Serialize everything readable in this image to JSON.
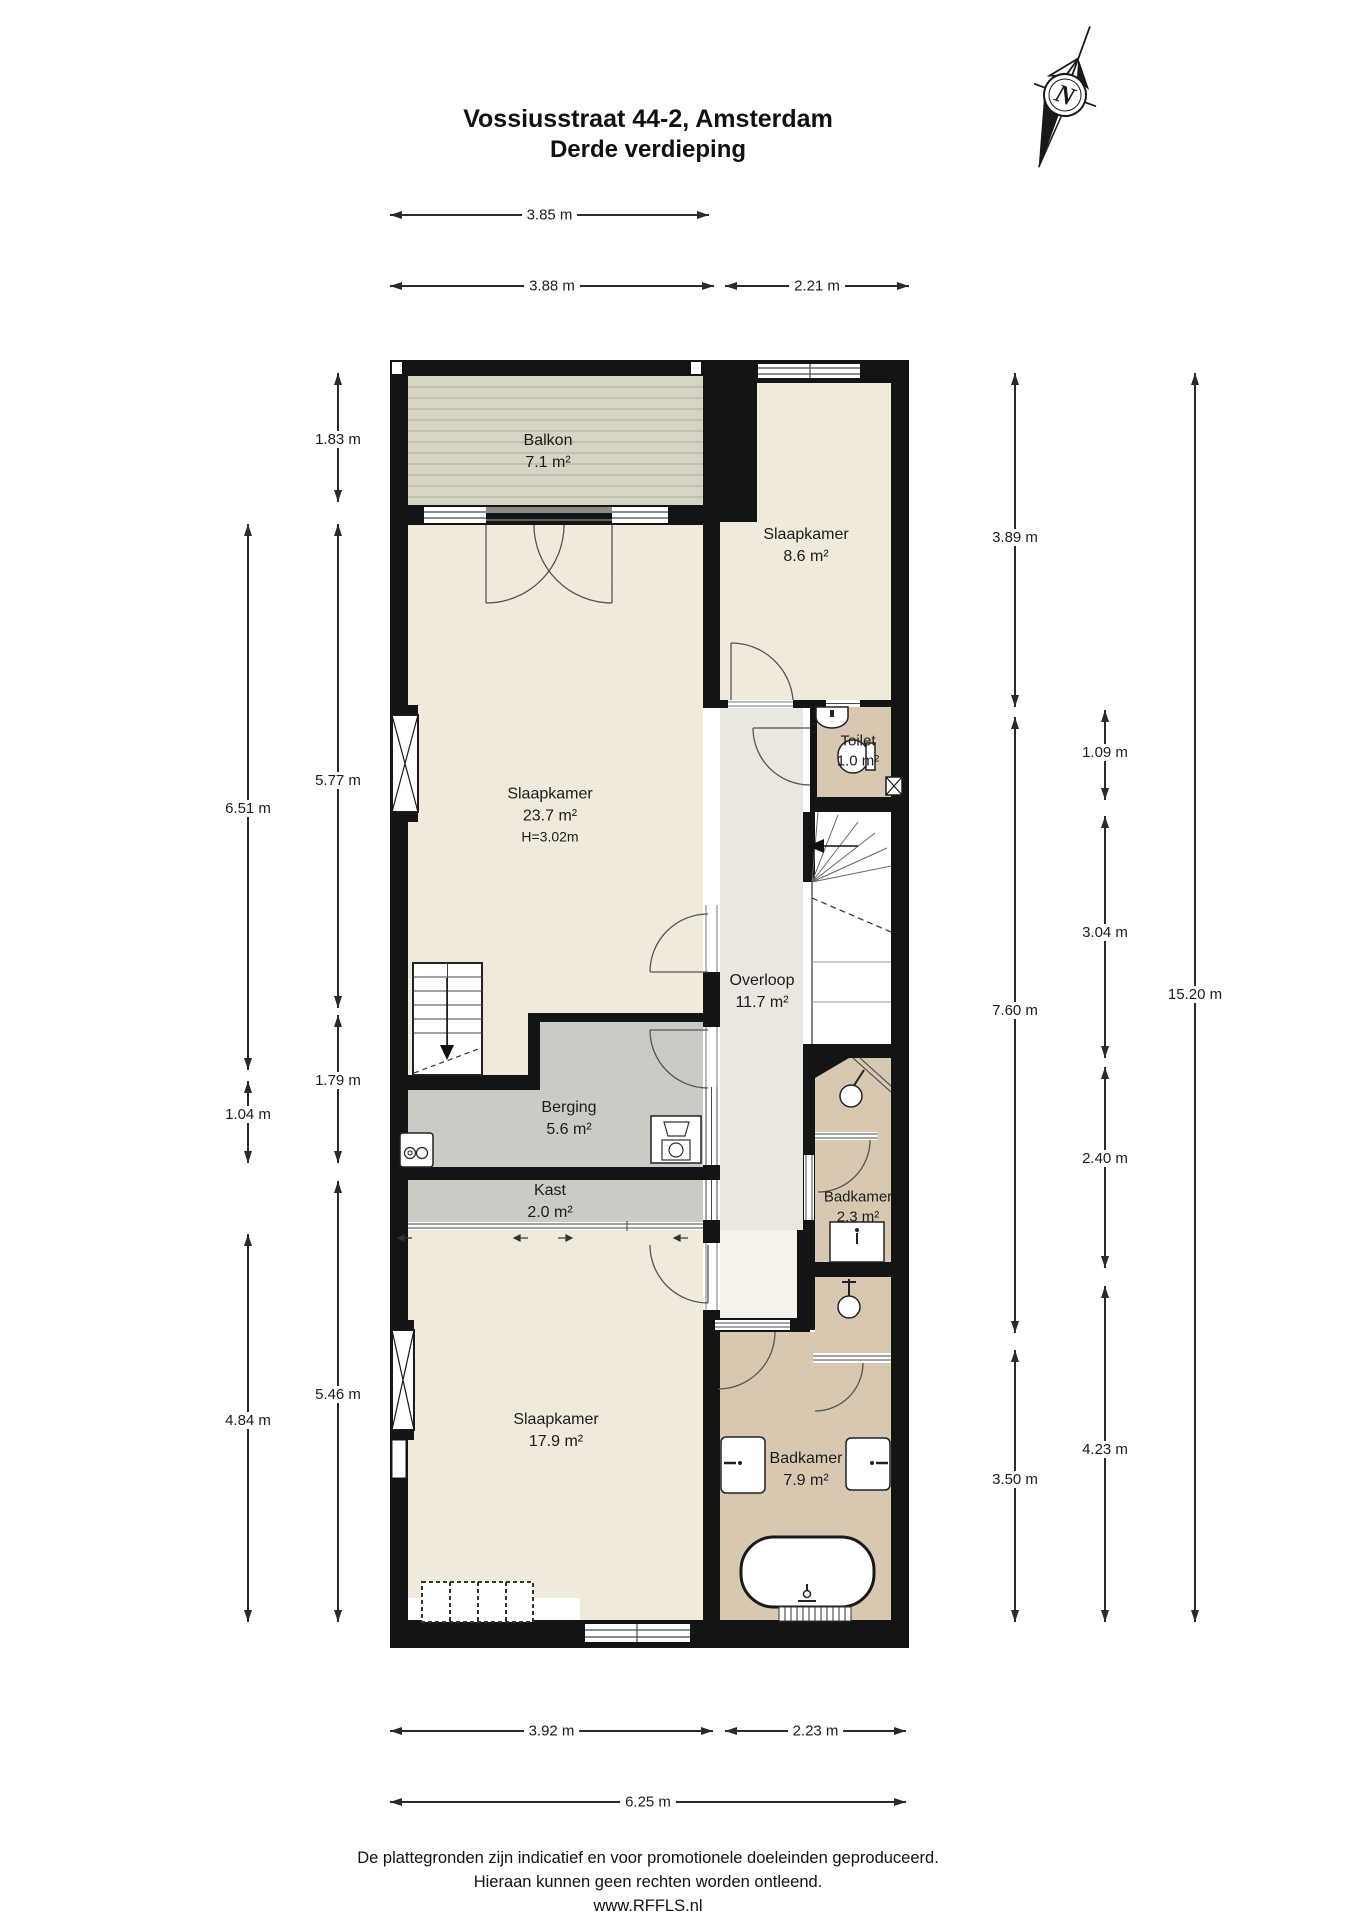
{
  "title": {
    "line1": "Vossiusstraat 44-2, Amsterdam",
    "line2": "Derde verdieping"
  },
  "compass": {
    "label": "N"
  },
  "rooms": [
    {
      "id": "balkon",
      "name": "Balkon",
      "area": "7.1 m²",
      "cx": 548,
      "cy": 452,
      "small": false
    },
    {
      "id": "slaapkamer-1",
      "name": "Slaapkamer",
      "area": "8.6 m²",
      "cx": 806,
      "cy": 546,
      "small": false
    },
    {
      "id": "slaapkamer-2",
      "name": "Slaapkamer",
      "area": "23.7 m²",
      "extra": "H=3.02m",
      "cx": 550,
      "cy": 815,
      "small": false
    },
    {
      "id": "toilet",
      "name": "Toilet",
      "area": "1.0 m²",
      "cx": 858,
      "cy": 751,
      "small": true
    },
    {
      "id": "overloop",
      "name": "Overloop",
      "area": "11.7 m²",
      "cx": 762,
      "cy": 992,
      "small": false
    },
    {
      "id": "berging",
      "name": "Berging",
      "area": "5.6 m²",
      "cx": 569,
      "cy": 1119,
      "small": false
    },
    {
      "id": "kast",
      "name": "Kast",
      "area": "2.0 m²",
      "cx": 550,
      "cy": 1202,
      "small": false
    },
    {
      "id": "badkamer-1",
      "name": "Badkamer",
      "area": "2.3 m²",
      "cx": 858,
      "cy": 1207,
      "small": true
    },
    {
      "id": "slaapkamer-3",
      "name": "Slaapkamer",
      "area": "17.9 m²",
      "cx": 556,
      "cy": 1431,
      "small": false
    },
    {
      "id": "badkamer-2",
      "name": "Badkamer",
      "area": "7.9 m²",
      "cx": 806,
      "cy": 1470,
      "small": false
    }
  ],
  "dims_h": [
    {
      "label": "3.85 m",
      "y": 215,
      "x1": 390,
      "x2": 709
    },
    {
      "label": "3.88 m",
      "y": 286,
      "x1": 390,
      "x2": 714
    },
    {
      "label": "2.21 m",
      "y": 286,
      "x1": 725,
      "x2": 909
    },
    {
      "label": "3.92 m",
      "y": 1731,
      "x1": 390,
      "x2": 713
    },
    {
      "label": "2.23 m",
      "y": 1731,
      "x1": 725,
      "x2": 906
    },
    {
      "label": "6.25 m",
      "y": 1802,
      "x1": 390,
      "x2": 906
    }
  ],
  "dims_v": [
    {
      "label": "1.83 m",
      "x": 338,
      "y1": 373,
      "y2": 502,
      "ly": 442
    },
    {
      "label": "5.77 m",
      "x": 338,
      "y1": 524,
      "y2": 1008,
      "ly": 783
    },
    {
      "label": "6.51 m",
      "x": 248,
      "y1": 524,
      "y2": 1070,
      "ly": 811
    },
    {
      "label": "1.79 m",
      "x": 338,
      "y1": 1015,
      "y2": 1163,
      "ly": 1083
    },
    {
      "label": "1.04 m",
      "x": 248,
      "y1": 1081,
      "y2": 1163,
      "ly": 1117
    },
    {
      "label": "5.46 m",
      "x": 338,
      "y1": 1181,
      "y2": 1622,
      "ly": 1397
    },
    {
      "label": "4.84 m",
      "x": 248,
      "y1": 1234,
      "y2": 1622,
      "ly": 1423
    },
    {
      "label": "3.89 m",
      "x": 1015,
      "y1": 373,
      "y2": 707,
      "ly": 540
    },
    {
      "label": "7.60 m",
      "x": 1015,
      "y1": 717,
      "y2": 1333,
      "ly": 1013
    },
    {
      "label": "3.50 m",
      "x": 1015,
      "y1": 1350,
      "y2": 1622,
      "ly": 1482
    },
    {
      "label": "1.09 m",
      "x": 1105,
      "y1": 710,
      "y2": 800,
      "ly": 755
    },
    {
      "label": "3.04 m",
      "x": 1105,
      "y1": 816,
      "y2": 1058,
      "ly": 935
    },
    {
      "label": "2.40 m",
      "x": 1105,
      "y1": 1067,
      "y2": 1268,
      "ly": 1161
    },
    {
      "label": "4.23 m",
      "x": 1105,
      "y1": 1286,
      "y2": 1622,
      "ly": 1452
    },
    {
      "label": "15.20 m",
      "x": 1195,
      "y1": 373,
      "y2": 1622,
      "ly": 997
    }
  ],
  "footer": {
    "line1": "De plattegronden zijn indicatief en voor promotionele doeleinden geproduceerd.",
    "line2": "Hieraan kunnen geen rechten worden ontleend.",
    "line3": "www.RFFLS.nl"
  },
  "colors": {
    "wall": "#141414",
    "room_beige": "#f0eadd",
    "hall": "#e9e7df",
    "vestibule": "#f4f2ea",
    "storage_gray": "#c9ccc5",
    "bath_tan": "#d9c8b1",
    "balcony": "#d7d4c6"
  }
}
